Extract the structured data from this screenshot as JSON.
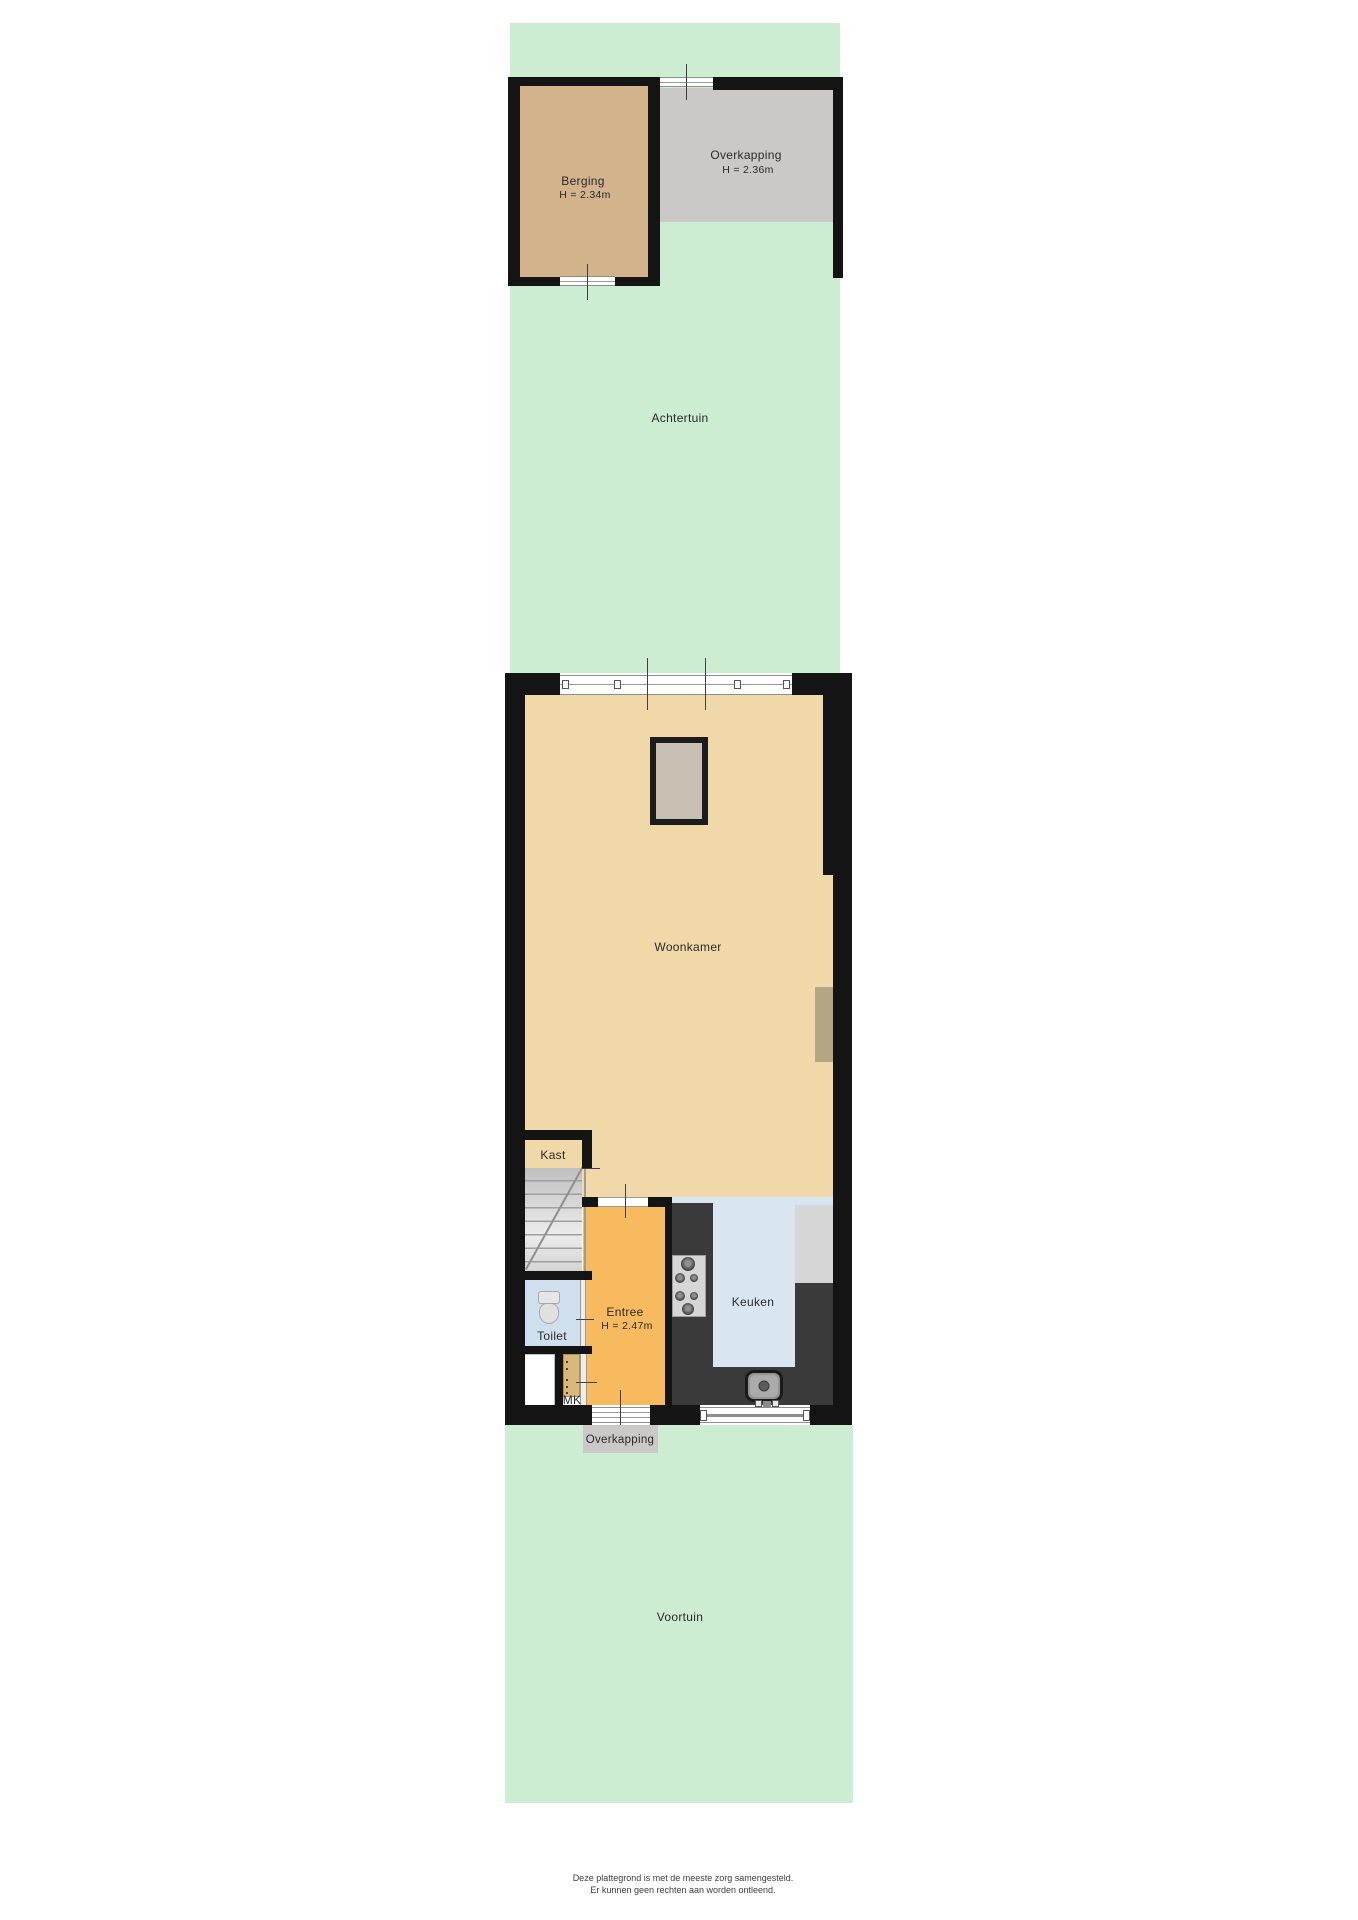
{
  "document": {
    "kind": "floorplan",
    "floor": "ground-floor"
  },
  "rooms": {
    "achtertuin": {
      "label": "Achtertuin"
    },
    "berging": {
      "label": "Berging",
      "height": "H = 2.34m"
    },
    "overkapping_top": {
      "label": "Overkapping",
      "height": "H = 2.36m"
    },
    "woonkamer": {
      "label": "Woonkamer"
    },
    "kast": {
      "label": "Kast"
    },
    "entree": {
      "label": "Entree",
      "height": "H = 2.47m"
    },
    "toilet": {
      "label": "Toilet"
    },
    "mk": {
      "label": "MK"
    },
    "keuken": {
      "label": "Keuken"
    },
    "overkapping_bottom": {
      "label": "Overkapping"
    },
    "voortuin": {
      "label": "Voortuin"
    }
  },
  "disclaimer": {
    "line1": "Deze plattegrond is met de meeste zorg samengesteld.",
    "line2": "Er kunnen geen rechten aan worden ontleend."
  },
  "colors": {
    "garden": "#cdedd2",
    "wall": "#141414",
    "floor": "#f1d8a8",
    "shedfloor": "#d2b38b",
    "canopy": "#cac9c7",
    "entry": "#f7ba5e",
    "kitchen": "#d9e6f1",
    "toiletfloor": "#cfdfee",
    "counter": "#3a3a3b",
    "appliance": "#d6d6d6",
    "radiator": "#b2a685",
    "objectfill": "#c8c0b2",
    "text": "#2a2a2a"
  }
}
